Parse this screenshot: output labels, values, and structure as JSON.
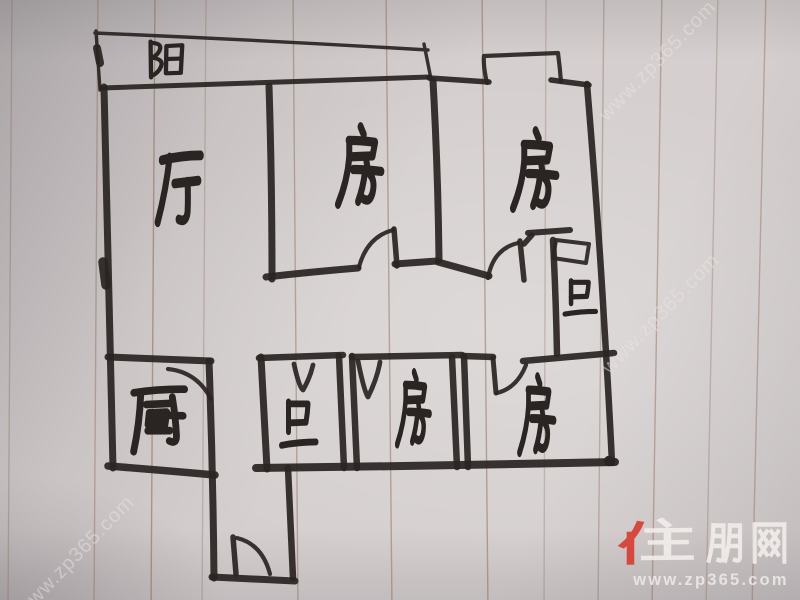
{
  "rooms": [
    {
      "key": "balcony",
      "label": "阳"
    },
    {
      "key": "living-room",
      "label": "厅"
    },
    {
      "key": "bedroom-top-middle",
      "label": "房"
    },
    {
      "key": "bedroom-top-right",
      "label": "房"
    },
    {
      "key": "bathroom-right",
      "label": "卫"
    },
    {
      "key": "kitchen",
      "label": "厨"
    },
    {
      "key": "bathroom-bottom",
      "label": "卫"
    },
    {
      "key": "bedroom-bottom-middle",
      "label": "房"
    },
    {
      "key": "bedroom-bottom-right",
      "label": "房"
    }
  ],
  "watermarks": {
    "diagonal_text": "www.zp365.com",
    "diagonal_count": 3,
    "logo_text": "住朋网",
    "logo_url": "www.zp365.com"
  },
  "colors": {
    "ink": "#2a2522",
    "paper": "#d5cfcf",
    "rule_line": "#8b6753",
    "logo_red": "#d8382c",
    "logo_white": "#f3efec",
    "watermark": "#e9e3e1"
  }
}
